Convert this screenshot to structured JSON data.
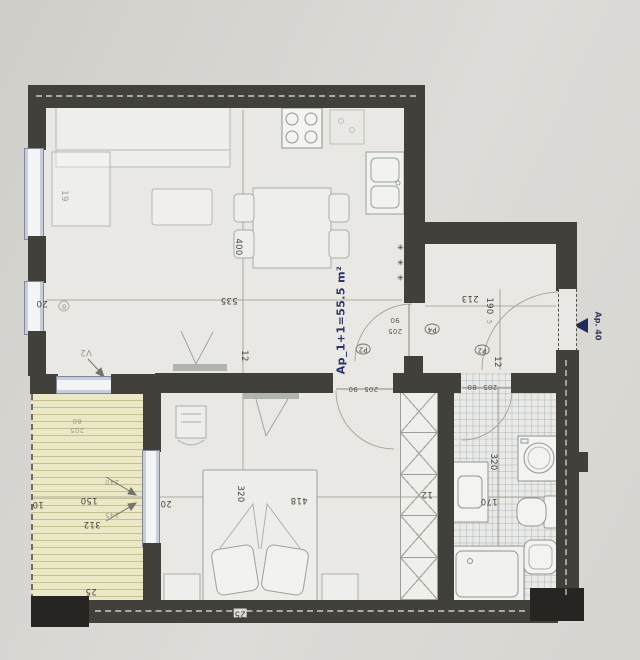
{
  "plan": {
    "title": "Ap_1+1=55.5 m²",
    "entry_label": "Ap. 40",
    "radiator_symbol": "✳ ✳ ✳",
    "colors": {
      "accent_navy": "#2c3567",
      "wall": "#41403b",
      "balcony": "#ebe8c6"
    },
    "labels": [
      {
        "t": "535",
        "x": 229,
        "y": 300,
        "r": 180
      },
      {
        "t": "400",
        "x": 238,
        "y": 247,
        "r": 90
      },
      {
        "t": "20",
        "x": 42,
        "y": 303,
        "r": 180
      },
      {
        "t": "8",
        "x": 64,
        "y": 306,
        "r": 180,
        "c": "cir ft"
      },
      {
        "t": "19",
        "x": 64,
        "y": 196,
        "r": 90,
        "c": "ft"
      },
      {
        "t": "V2",
        "x": 86,
        "y": 352,
        "r": 180,
        "c": "ft"
      },
      {
        "t": "213",
        "x": 470,
        "y": 298,
        "r": 180
      },
      {
        "t": "190",
        "x": 489,
        "y": 306,
        "r": 90
      },
      {
        "t": "5",
        "x": 489,
        "y": 322,
        "r": 90,
        "c": "sm ft"
      },
      {
        "t": "90",
        "x": 395,
        "y": 320,
        "r": 180,
        "c": "sm"
      },
      {
        "t": "205",
        "x": 395,
        "y": 331,
        "r": 180,
        "c": "sm"
      },
      {
        "t": "P4",
        "x": 432,
        "y": 329,
        "r": 180,
        "c": "cir"
      },
      {
        "t": "P2",
        "x": 363,
        "y": 349,
        "r": 180,
        "c": "cir"
      },
      {
        "t": "12",
        "x": 244,
        "y": 356,
        "r": 90
      },
      {
        "t": "P2",
        "x": 482,
        "y": 350,
        "r": 180,
        "c": "cir"
      },
      {
        "t": "12",
        "x": 497,
        "y": 362,
        "r": 90
      },
      {
        "t": "90",
        "x": 353,
        "y": 389,
        "r": 180,
        "c": "sm"
      },
      {
        "t": "205",
        "x": 371,
        "y": 389,
        "r": 180,
        "c": "sm"
      },
      {
        "t": "80",
        "x": 472,
        "y": 387,
        "r": 180,
        "c": "sm"
      },
      {
        "t": "205",
        "x": 490,
        "y": 387,
        "r": 180,
        "c": "sm"
      },
      {
        "t": "320",
        "x": 240,
        "y": 494,
        "r": 90
      },
      {
        "t": "418",
        "x": 299,
        "y": 500,
        "r": 180
      },
      {
        "t": "20",
        "x": 166,
        "y": 503,
        "r": 180
      },
      {
        "t": "150",
        "x": 89,
        "y": 500,
        "r": 180
      },
      {
        "t": "312",
        "x": 92,
        "y": 524,
        "r": 180
      },
      {
        "t": "10",
        "x": 38,
        "y": 504,
        "r": 180
      },
      {
        "t": "25",
        "x": 91,
        "y": 591,
        "r": 180
      },
      {
        "t": "25",
        "x": 240,
        "y": 613,
        "r": 180,
        "c": "pill"
      },
      {
        "t": "320",
        "x": 493,
        "y": 462,
        "r": 90
      },
      {
        "t": "170",
        "x": 489,
        "y": 501,
        "r": 180
      },
      {
        "t": "12",
        "x": 427,
        "y": 494,
        "r": 180
      },
      {
        "t": "240",
        "x": 112,
        "y": 482,
        "r": 180,
        "c": "sm ft"
      },
      {
        "t": "145",
        "x": 112,
        "y": 515,
        "r": 180,
        "c": "sm ft"
      },
      {
        "t": "60",
        "x": 77,
        "y": 421,
        "r": 180,
        "c": "sm ft"
      },
      {
        "t": "205",
        "x": 77,
        "y": 430,
        "r": 180,
        "c": "sm ft"
      }
    ]
  }
}
